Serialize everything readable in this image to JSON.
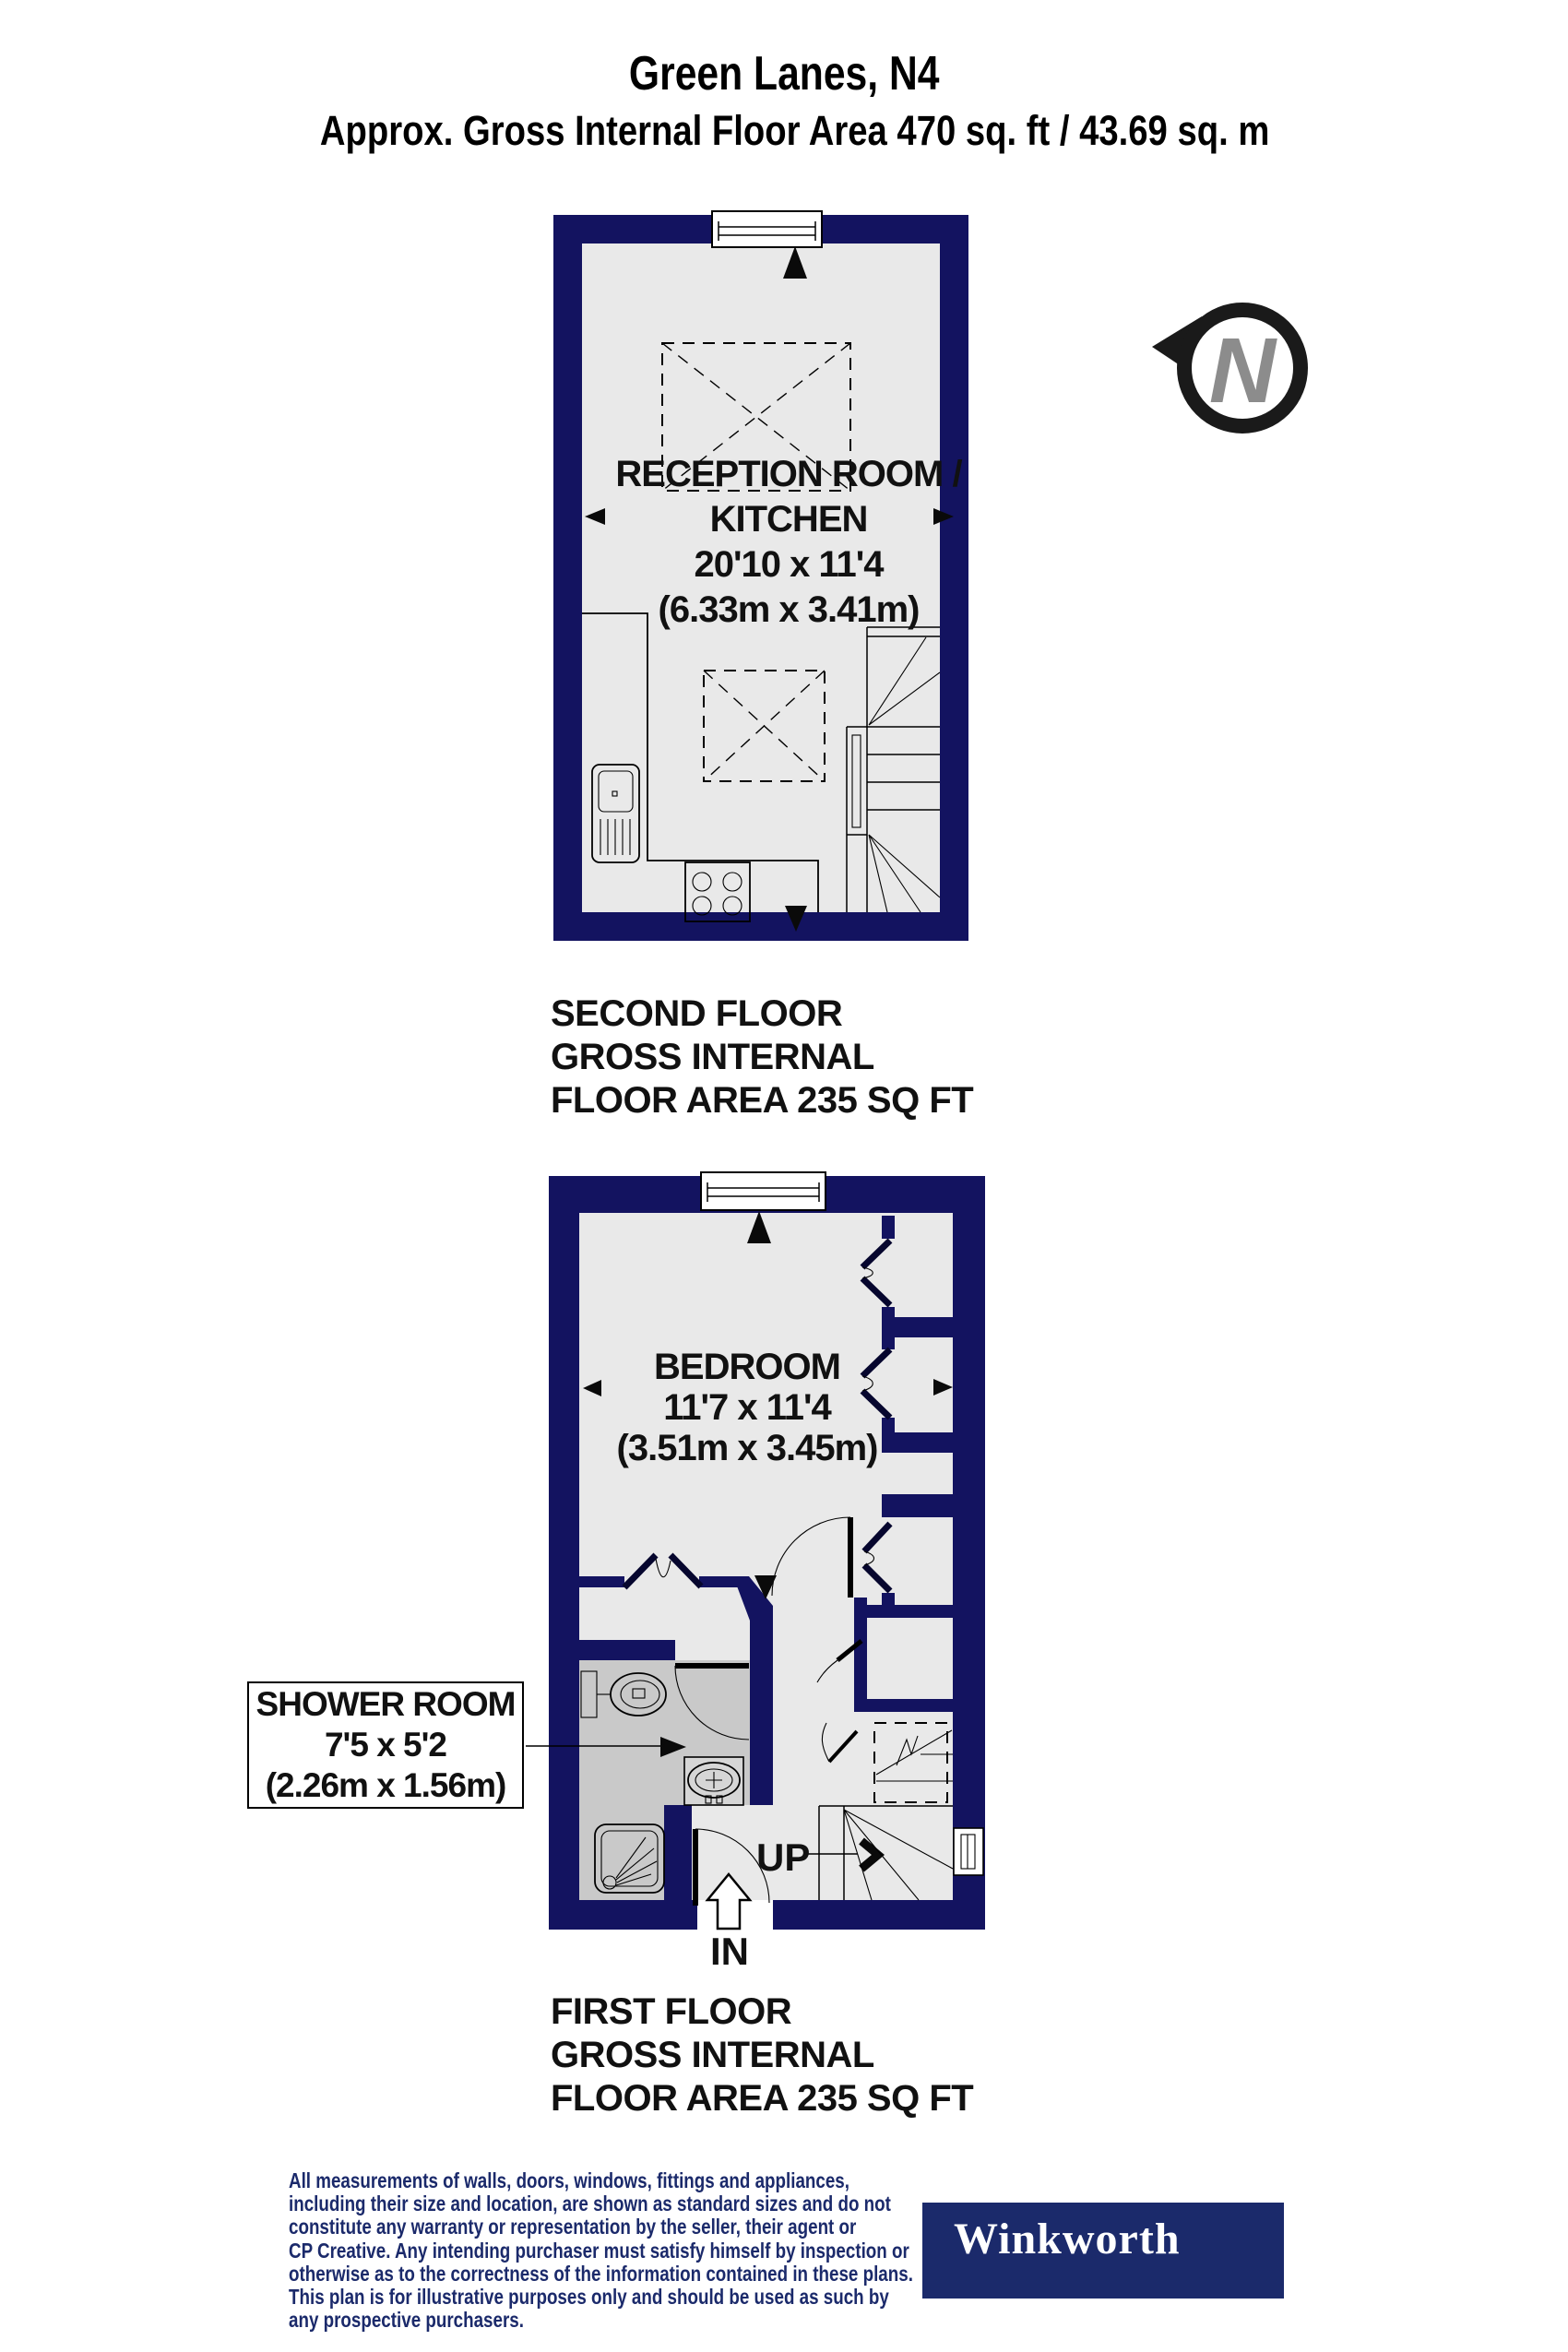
{
  "header": {
    "title": "Green Lanes, N4",
    "subtitle": "Approx. Gross Internal Floor Area 470 sq. ft / 43.69 sq. m"
  },
  "compass": {
    "north_letter": "N"
  },
  "second_floor": {
    "room": {
      "name_line1": "RECEPTION ROOM /",
      "name_line2": "KITCHEN",
      "dims_imperial": "20'10 x 11'4",
      "dims_metric": "(6.33m x 3.41m)"
    },
    "caption": {
      "line1": "SECOND FLOOR",
      "line2": "GROSS INTERNAL",
      "line3": "FLOOR AREA 235 SQ FT"
    }
  },
  "first_floor": {
    "bedroom": {
      "name": "BEDROOM",
      "dims_imperial": "11'7 x 11'4",
      "dims_metric": "(3.51m x 3.45m)"
    },
    "shower_room": {
      "name": "SHOWER ROOM",
      "dims_imperial": "7'5 x 5'2",
      "dims_metric": "(2.26m x 1.56m)"
    },
    "stairs_label": "UP",
    "entrance_label": "IN",
    "caption": {
      "line1": "FIRST FLOOR",
      "line2": "GROSS INTERNAL",
      "line3": "FLOOR AREA 235 SQ FT"
    }
  },
  "footer": {
    "disclaimer_lines": [
      "All measurements of walls, doors, windows, fittings and appliances,",
      "including their size and location, are shown as standard sizes and do not",
      "constitute any warranty or representation by the seller, their agent or",
      "CP Creative. Any intending purchaser must satisfy himself by inspection or",
      "otherwise as to the correctness of the information contained in these plans.",
      "This plan is for illustrative purposes only and should be used as such by",
      "any prospective purchasers."
    ],
    "brand_name": "Winkworth"
  },
  "colors": {
    "wall_navy": "#131360",
    "floor_gray": "#e9e9e9",
    "shower_gray": "#c9c9c9",
    "brand_navy": "#1b2a6b"
  }
}
